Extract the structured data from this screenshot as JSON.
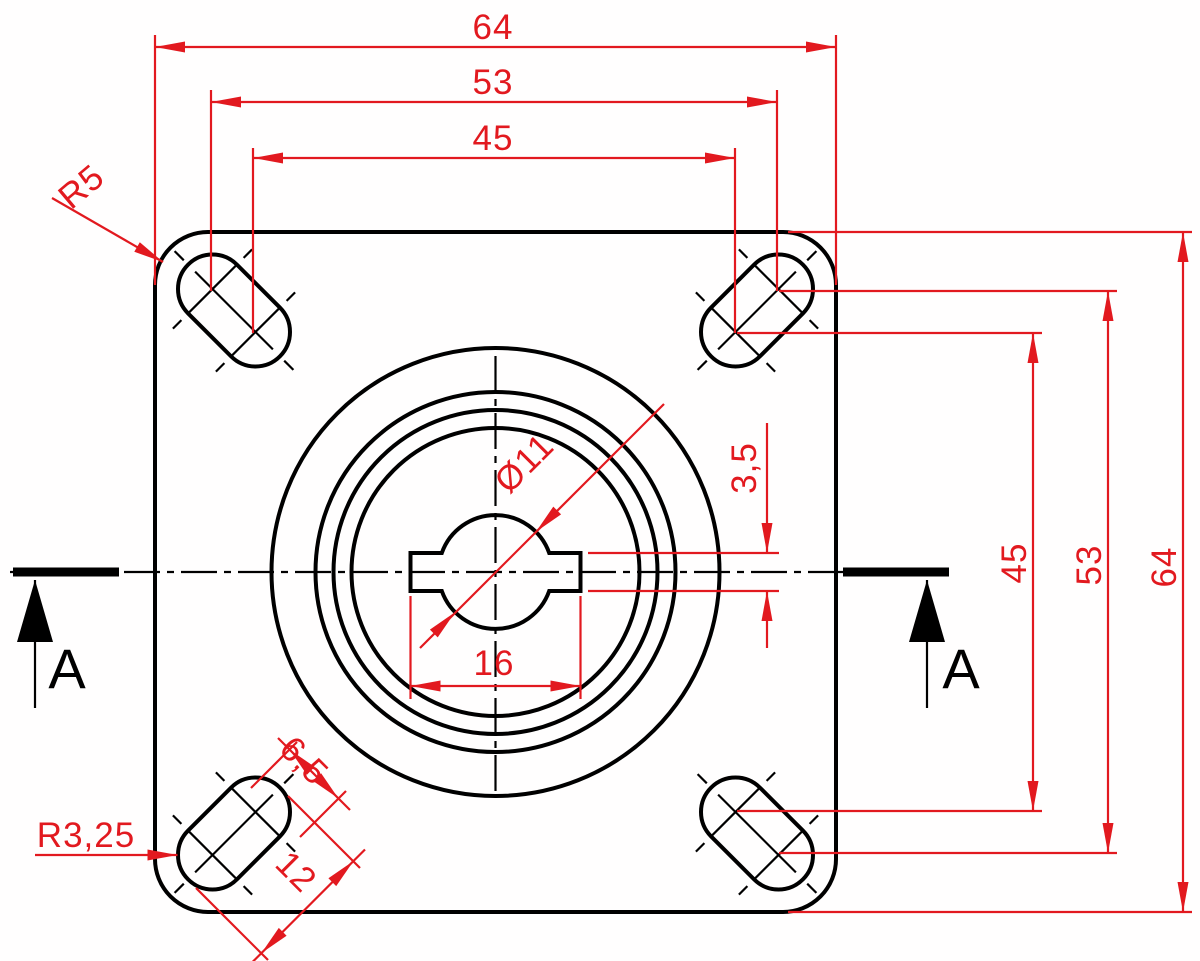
{
  "drawing": {
    "type": "technical-dimension-drawing",
    "view": "caster-top-plate-plan-view",
    "colors": {
      "dimension_red": "#e2191f",
      "outline_black": "#000000",
      "background": "#ffffff"
    },
    "dimensions": {
      "top_width_outer": "64",
      "top_slot_outer_span": "53",
      "top_slot_inner_span": "45",
      "right_slot_inner_span": "45",
      "right_slot_outer_span": "53",
      "right_height_outer": "64",
      "hole_diameter": "Ø11",
      "hole_slot_width": "16",
      "hole_slot_height": "3,5",
      "corner_radius": "R5",
      "slot_end_radius": "R3,25",
      "slot_width": "6,5",
      "slot_length": "12"
    },
    "section": {
      "left_label": "A",
      "right_label": "A"
    }
  }
}
